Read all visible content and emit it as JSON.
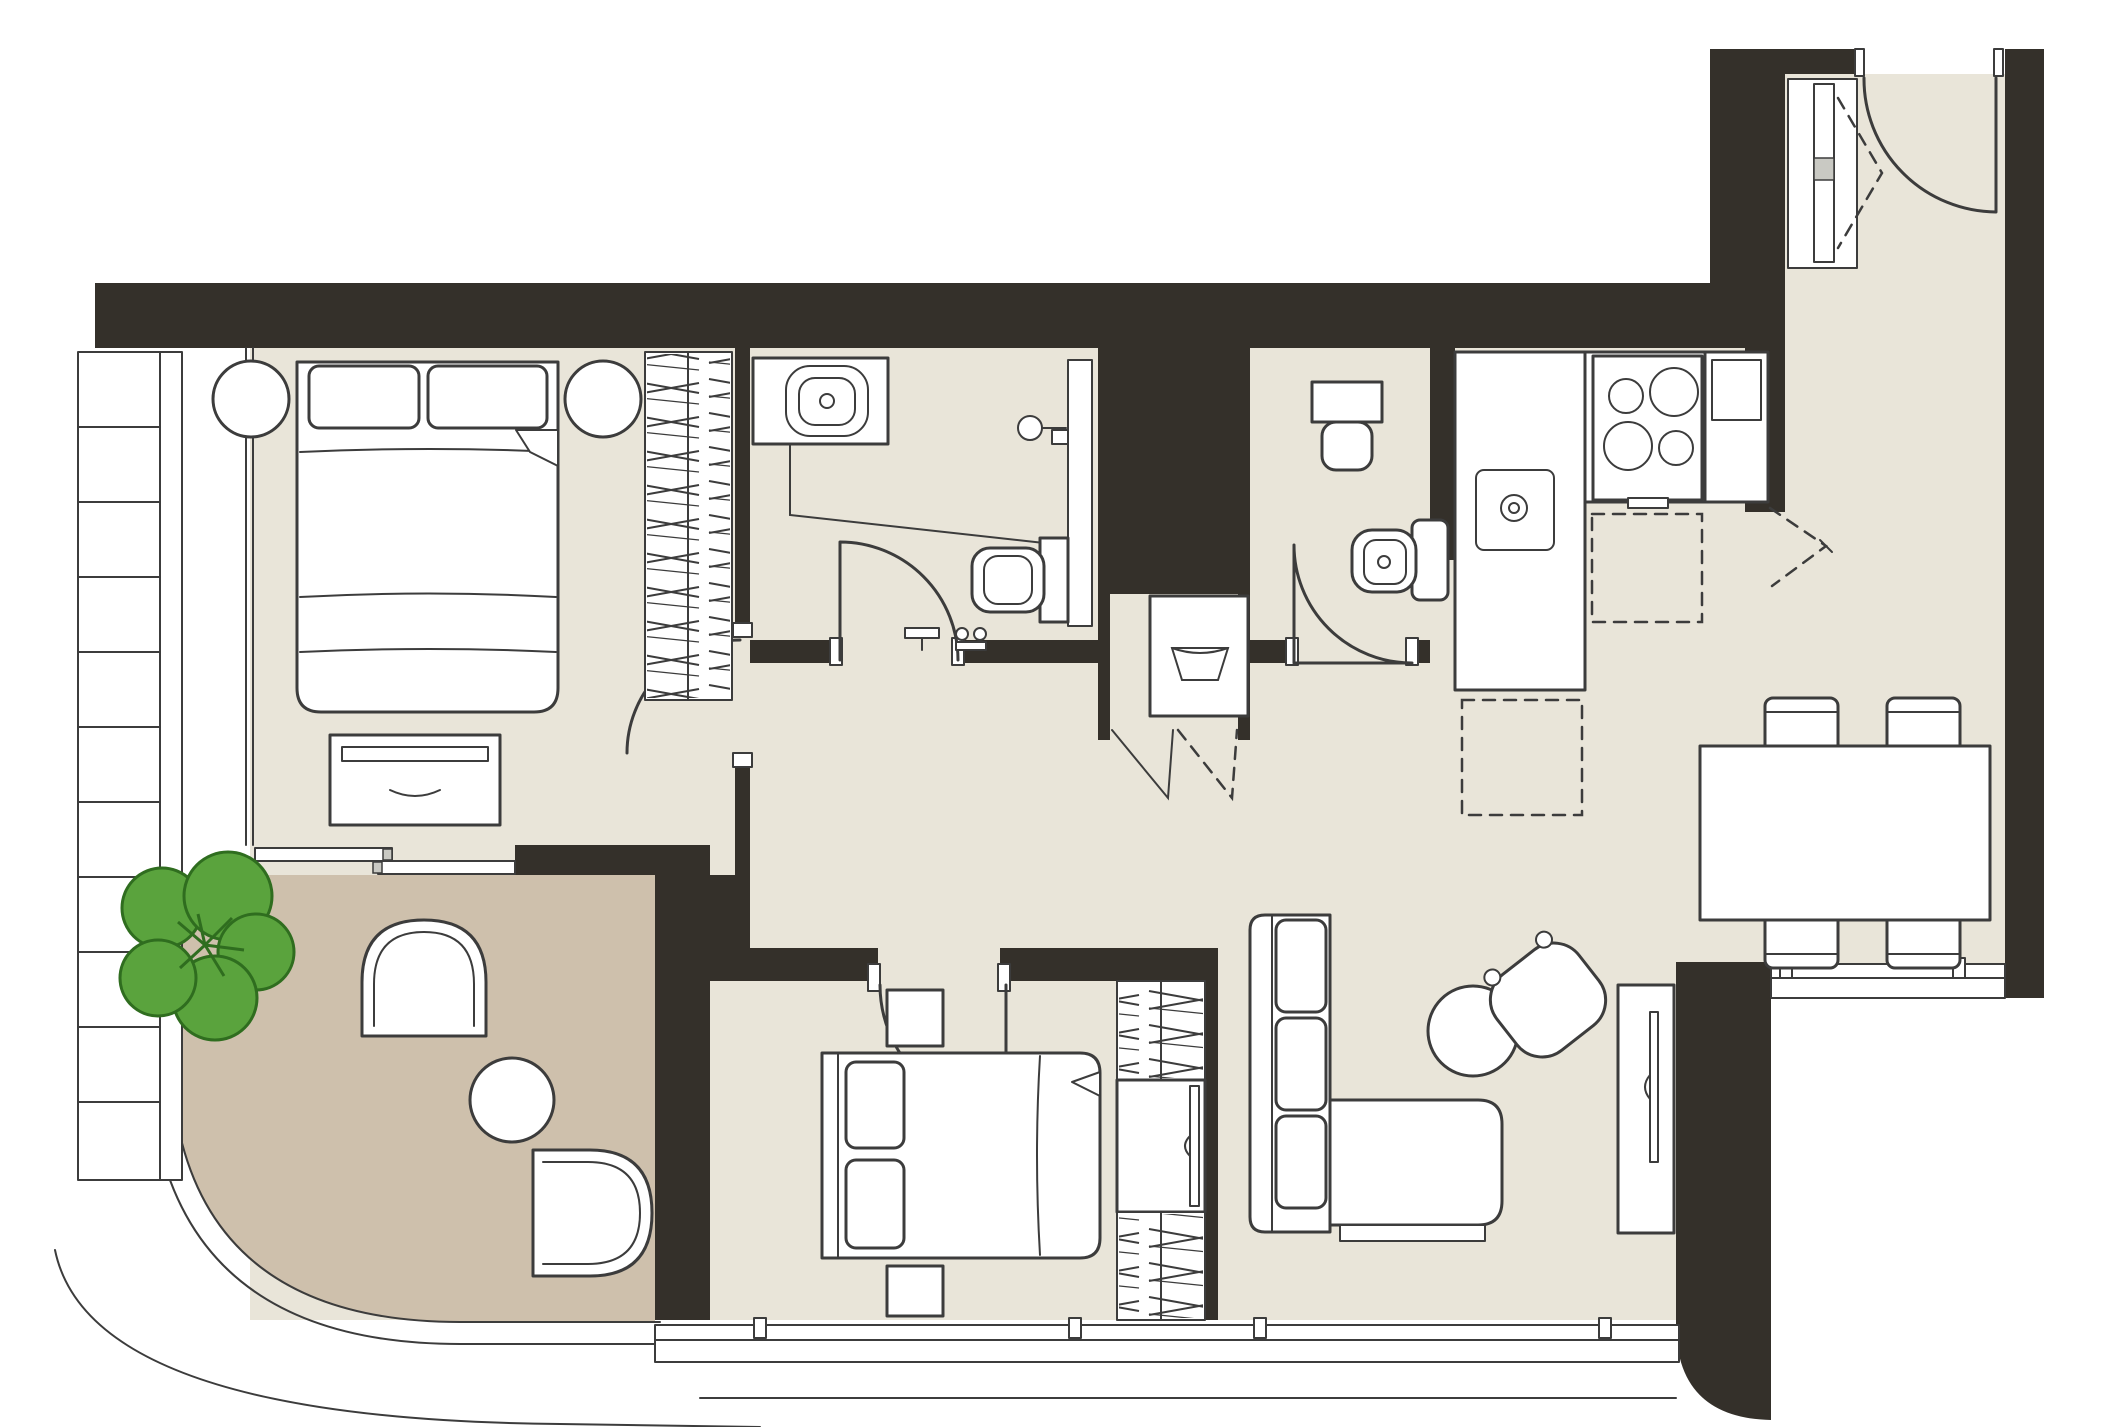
{
  "canvas": {
    "width": 2113,
    "height": 1427
  },
  "palette": {
    "exterior": "#ffffff",
    "wall": "#34302a",
    "line": "#3c3c3c",
    "floor": "#e9e5d9",
    "balcony": "#cec0ac",
    "furn": "#ffffff",
    "tree": "#5aa33d",
    "treeln": "#2f6d1f",
    "handle": "#c9c9c3"
  },
  "plan": {
    "type": "apartment-floor-plan",
    "labels_visible": false,
    "rooms": [
      {
        "id": "bedroom-1",
        "name": "master bedroom",
        "furniture": [
          "double-bed",
          "pillow",
          "pillow",
          "round-nightstand",
          "round-nightstand",
          "hanging-wardrobe",
          "dresser",
          "sliding-balcony-door",
          "louvered-screen"
        ]
      },
      {
        "id": "bathroom-1",
        "name": "ensuite bathroom",
        "furniture": [
          "vanity-sink",
          "shower-head",
          "glass-partition",
          "wall-hung-toilet",
          "swing-door",
          "accessories"
        ]
      },
      {
        "id": "laundry-closet",
        "name": "laundry closet",
        "furniture": [
          "washing-machine",
          "bifold-doors"
        ]
      },
      {
        "id": "wc",
        "name": "guest wc",
        "furniture": [
          "wall-hung-toilet",
          "bidet",
          "swing-door"
        ]
      },
      {
        "id": "kitchen",
        "name": "kitchen",
        "furniture": [
          "l-shaped-counter",
          "sink",
          "hob-4-burners",
          "tall-fridge-unit",
          "dashed-appliance",
          "dashed-appliance"
        ]
      },
      {
        "id": "hallway",
        "name": "entrance hall",
        "furniture": [
          "entry-door",
          "bifold-closet"
        ]
      },
      {
        "id": "living-dining",
        "name": "living and dining room",
        "furniture": [
          "sofa-with-chaise",
          "coffee-table",
          "armchair",
          "tv-console",
          "dining-table",
          "chair",
          "chair",
          "chair",
          "chair"
        ]
      },
      {
        "id": "bedroom-2",
        "name": "second bedroom",
        "furniture": [
          "double-bed",
          "pillow",
          "pillow",
          "nightstand",
          "nightstand",
          "wardrobe-tv-unit",
          "swing-door"
        ]
      },
      {
        "id": "balcony",
        "name": "curved terrace",
        "furniture": [
          "tree-planter",
          "lounge-chair",
          "lounge-chair",
          "round-side-table",
          "curved-parapet"
        ]
      }
    ]
  }
}
